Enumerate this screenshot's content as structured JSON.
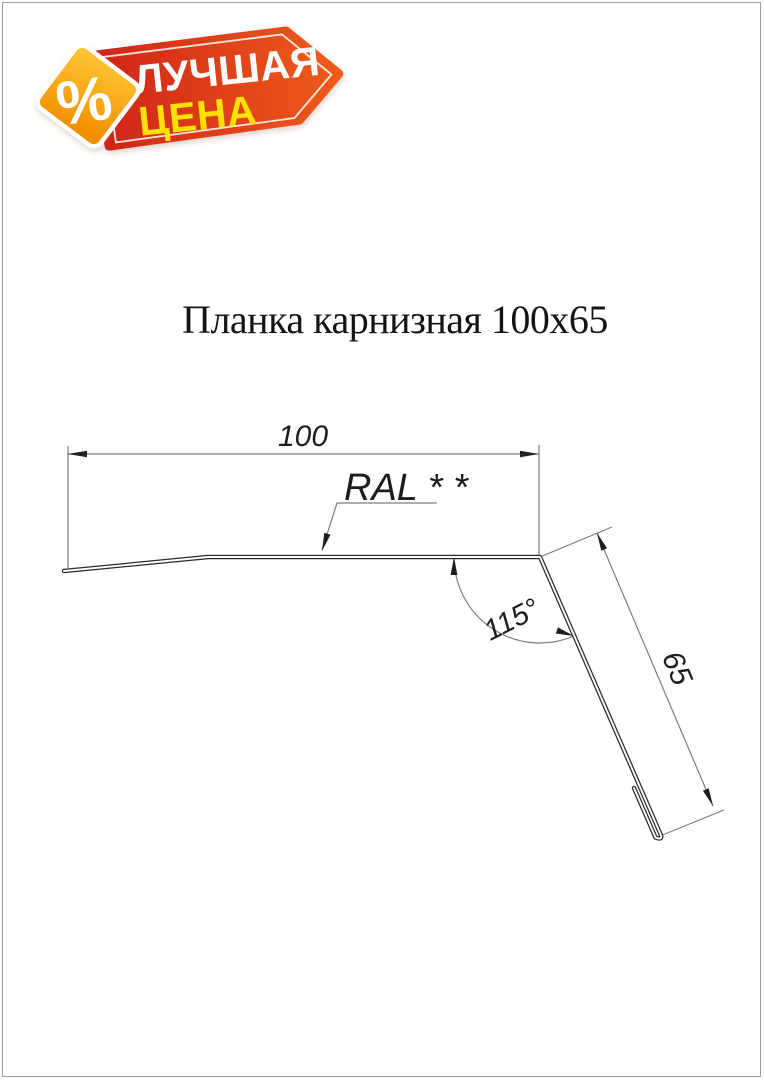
{
  "title": {
    "text": "Планка карнизная 100x65"
  },
  "badge": {
    "percent": "%",
    "line1": "ЛУЧШАЯ",
    "line2": "ЦЕНА",
    "colors": {
      "banner_left": "#cf2418",
      "banner_right": "#ee5c1b",
      "diamond_top": "#ffc637",
      "diamond_bottom": "#f19000",
      "line1_text": "#ffffff",
      "line2_text": "#ffe003",
      "percent_text": "#ffffff"
    }
  },
  "drawing": {
    "dim_width": "100",
    "dim_height": "65",
    "dim_angle": "115°",
    "coating_label": "RAL * *"
  }
}
